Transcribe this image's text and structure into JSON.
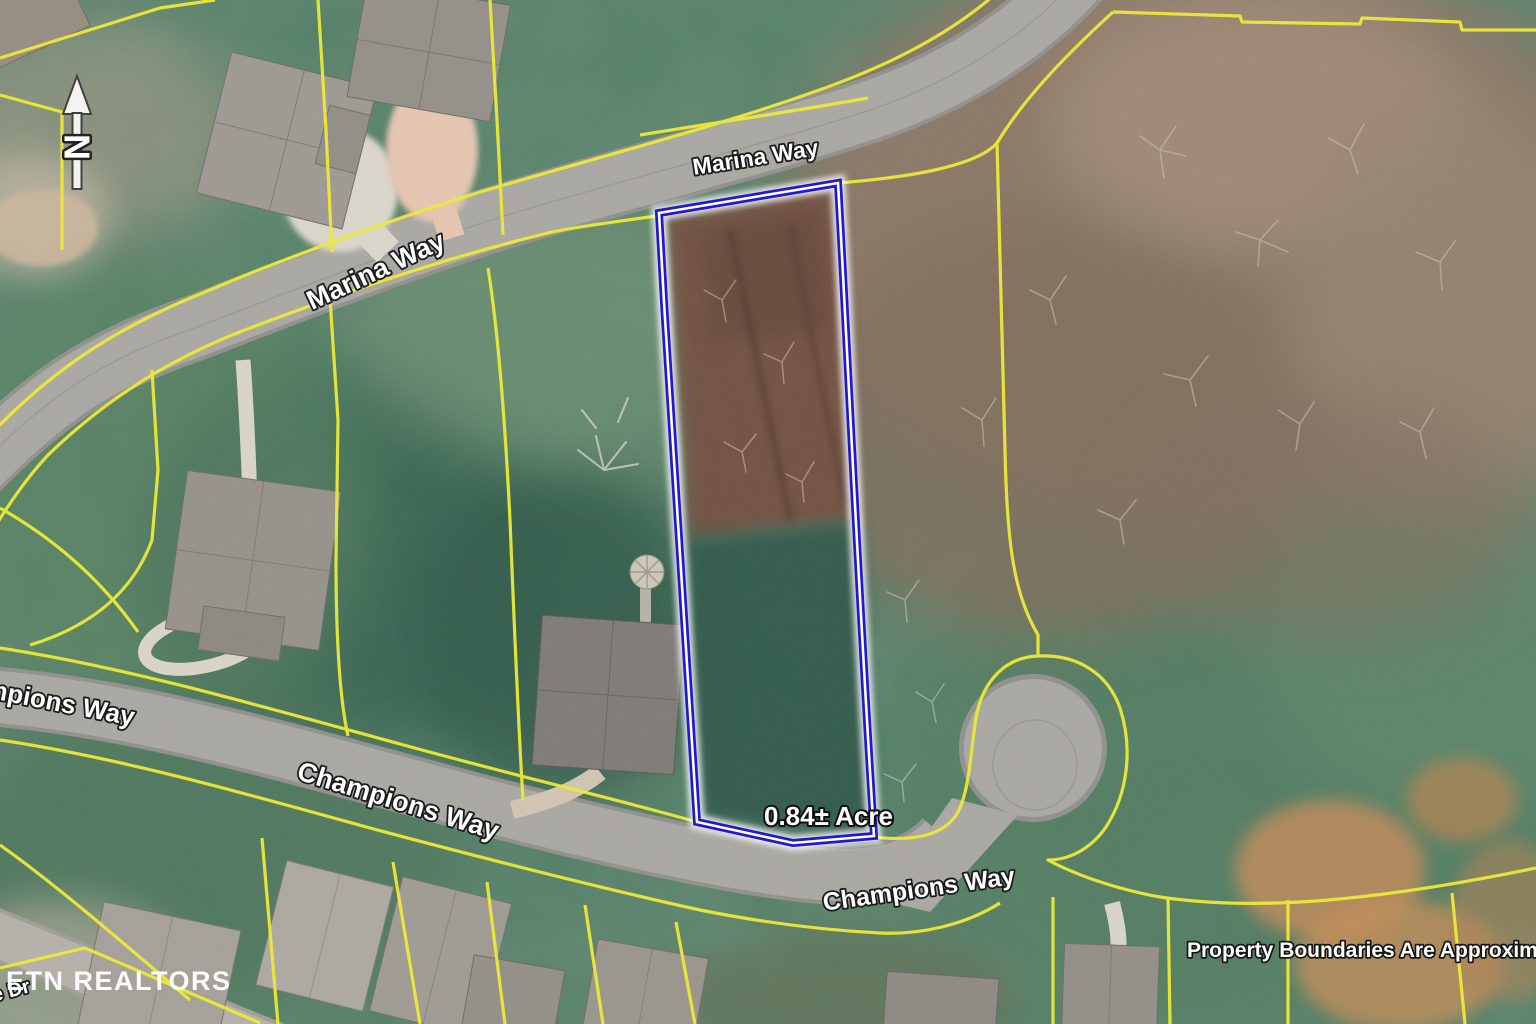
{
  "map": {
    "title": "Aerial parcel map with highlighted lot",
    "north_indicator": "N",
    "labels": {
      "marina_way": "Marina Way",
      "champions_way": "Champions Way",
      "partial_street": "e Dr",
      "acreage": "0.84± Acre"
    },
    "watermark": "ETN REALTORS",
    "disclaimer": "Property Boundaries Are Approximate",
    "colors": {
      "parcel_line": "#ece938",
      "lot_outline": "#2317cf",
      "road": "#a7a5a0",
      "label_text": "#ffffff",
      "terrain_green": "#4e7a63",
      "cleared_lot_brown": "#6f4e3e"
    }
  }
}
